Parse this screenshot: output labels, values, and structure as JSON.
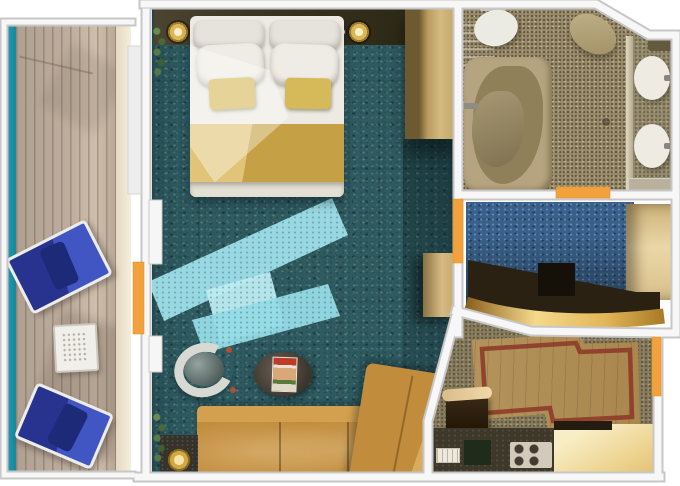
{
  "meta": {
    "description": "Top-down 3D rendered floor plan of a cruise ship balcony suite",
    "width_px": 680,
    "height_px": 486
  },
  "colors": {
    "sea": "#1f93a8",
    "deck_wood": "#bcab9b",
    "carpet_main_teal": "#2e5a60",
    "carpet_dressing_blue": "#39608a",
    "sunlight_streak": "#9edfe9",
    "bed_runner_gold": "#c9a44a",
    "sofa_leather": "#c18c3c",
    "door_marker_orange": "#f2a13c",
    "bathroom_floor": "#97896a",
    "entry_wood": "#b2935e",
    "rug_border_red": "#8e3b28",
    "wall_white": "#f7f7f7",
    "cabinet_tan": "#d2b87e"
  },
  "rooms": {
    "balcony": {
      "label": "Balcony",
      "items": [
        "lounge chair",
        "lounge chair",
        "mesh side table"
      ],
      "sea_edge": "teal water stripe"
    },
    "main_cabin": {
      "label": "Main cabin",
      "items": [
        "double bed with gold runner",
        "two bedside lamps",
        "four white pillows",
        "two gold accent pillows",
        "tall wardrobe",
        "mid cabinet",
        "tub chair",
        "round coffee table with magazine",
        "L-shaped leather sofa",
        "floor lamp on side table",
        "two plants",
        "sunlight streaks on carpet"
      ]
    },
    "bathroom": {
      "label": "Bathroom",
      "items": [
        "bathtub",
        "toilet",
        "vanity basin",
        "divider wall",
        "two oval sinks",
        "shelf"
      ]
    },
    "dressing_area": {
      "label": "Dressing area",
      "items": [
        "vanity desk with curved gold front",
        "stool",
        "closet"
      ]
    },
    "entry": {
      "label": "Entry hall",
      "items": [
        "wood floor with red border inlay",
        "console table",
        "minibar counter",
        "coffee set",
        "gold counter"
      ]
    }
  },
  "doors": [
    {
      "label": "Balcony door",
      "location": "balcony wall",
      "color": "#f2a13c"
    },
    {
      "label": "Bathroom door",
      "location": "bathroom bottom wall",
      "color": "#f2a13c"
    },
    {
      "label": "Dressing area door",
      "location": "main cabin right wall",
      "color": "#f2a13c"
    },
    {
      "label": "Entry door",
      "location": "entry right wall",
      "color": "#f2a13c"
    }
  ]
}
